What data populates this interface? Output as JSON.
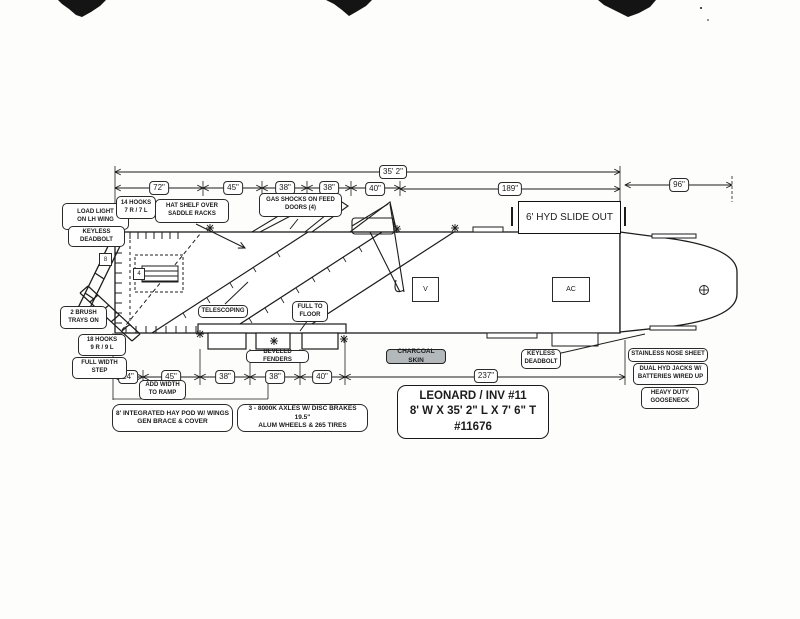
{
  "drawing": {
    "title_block": {
      "line1": "LEONARD / INV #11",
      "line2": "8' W X 35' 2\" L X 7' 6\" T",
      "line3": "#11676"
    },
    "dimensions": {
      "overall_length": "35' 2\"",
      "top_row": [
        "72\"",
        "45\"",
        "38\"",
        "38\"",
        "40\"",
        "189\""
      ],
      "gooseneck_length": "96\"",
      "bottom_row": [
        "24\"",
        "45\"",
        "38\"",
        "38\"",
        "40\""
      ],
      "bottom_overall": "237\""
    },
    "features": {
      "slide_out": "6' HYD SLIDE OUT",
      "vent": "V",
      "ac_unit": "AC",
      "rack_marker": "4",
      "door_marker": "8"
    },
    "callouts": {
      "load_light": "LOAD LIGHT\nON LH WING",
      "keyless_deadbolt_left": "KEYLESS\nDEADBOLT",
      "hooks_top": "14 HOOKS\n7 R / 7 L",
      "hat_shelf": "HAT SHELF OVER\nSADDLE RACKS",
      "gas_shocks": "GAS SHOCKS ON FEED\nDOORS (4)",
      "brush_trays": "2 BRUSH\nTRAYS ON",
      "hooks_bottom": "18 HOOKS\n9 R / 9 L",
      "full_width_step": "FULL WIDTH\nSTEP",
      "telescoping": "TELESCOPING",
      "full_to_floor": "FULL TO\nFLOOR",
      "beveled_fenders": "BEVELED FENDERS",
      "charcoal_skin": "CHARCOAL SKIN",
      "keyless_deadbolt_right": "KEYLESS\nDEADBOLT",
      "add_width_to_ramp": "ADD WIDTH\nTO RAMP",
      "hay_pod": "8' INTEGRATED HAY POD W/ WINGS\nGEN BRACE & COVER",
      "axles": "3 - 8000K AXLES W/ DISC BRAKES 19.5\"\nALUM WHEELS & 265 TIRES",
      "stainless_nose": "STAINLESS NOSE SHEET",
      "hyd_jacks": "DUAL HYD JACKS W/\nBATTERIES WIRED UP",
      "heavy_duty_gooseneck": "HEAVY DUTY\nGOOSENECK"
    }
  }
}
